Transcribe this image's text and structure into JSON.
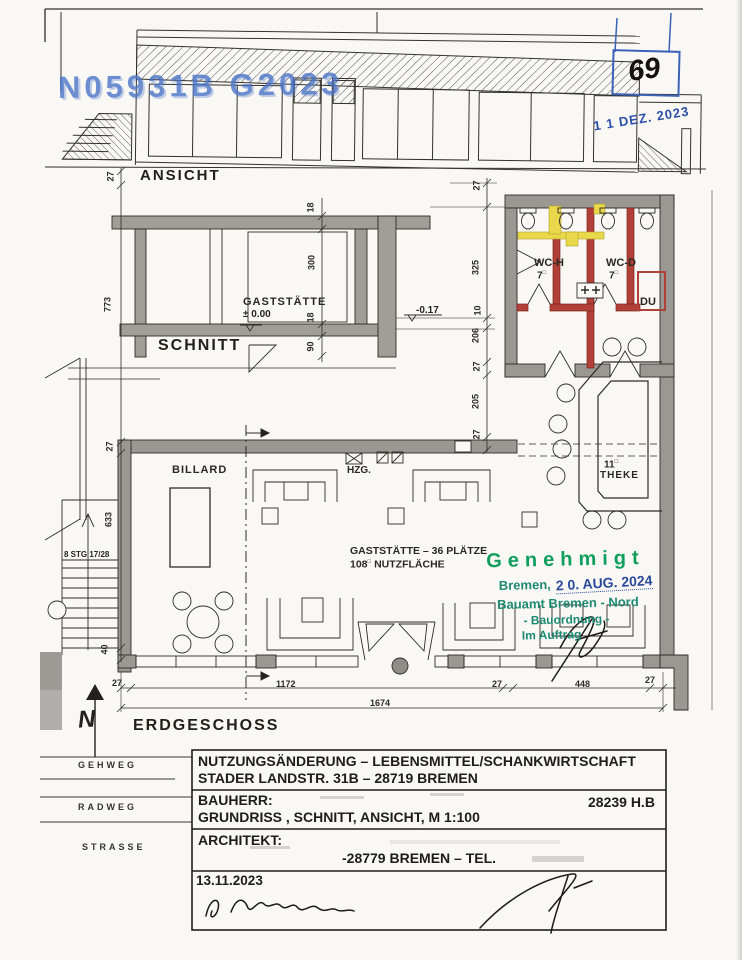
{
  "stamps": {
    "file_number": "N05931B G2023",
    "sheet_number": "69",
    "received_date": "1 1 DEZ. 2023",
    "approval": {
      "title": "Genehmigt",
      "city_prefix": "Bremen,",
      "city_date": "2 0. AUG. 2024",
      "authority": "Bauamt Bremen - Nord",
      "department": "- Bauordnung -",
      "by_order": "Im Auftrag"
    }
  },
  "views": {
    "elevation_label": "ANSICHT",
    "section_label": "SCHNITT",
    "floor_label": "ERDGESCHOSS"
  },
  "rooms": {
    "gaststaette": "GASTSTÄTTE",
    "level_zero": "± 0.00",
    "level_minus": "-0.17",
    "wc_h": {
      "name": "WC-H",
      "area": "7",
      "unit": "□"
    },
    "wc_d": {
      "name": "WC-D",
      "area": "7",
      "unit": "□"
    },
    "du": "DU",
    "theke": {
      "num": "11",
      "unit": "□",
      "name": "THEKE"
    },
    "billard": "BILLARD",
    "hzg": "HZG.",
    "gast": {
      "line1": "GASTSTÄTTE – 36 PLÄTZE",
      "num": "108",
      "unit": "□",
      "line2": "NUTZFLÄCHE"
    },
    "stairs": "8 STG 17/28"
  },
  "dims": {
    "d27": "27",
    "d773": "773",
    "d633": "633",
    "d40": "40",
    "d18": "18",
    "d300": "300",
    "d90": "90",
    "d325": "325",
    "d10": "10",
    "d206": "206",
    "d205": "205",
    "d1172": "1172",
    "d448": "448",
    "d1674": "1674"
  },
  "streets": {
    "gehweg": "GEHWEG",
    "radweg": "RADWEG",
    "strasse": "STRASSE"
  },
  "north": {
    "label": "N"
  },
  "titleblock": {
    "line1": "NUTZUNGSÄNDERUNG – LEBENSMITTEL/SCHANKWIRTSCHAFT",
    "line2": "STADER LANDSTR. 31B – 28719 BREMEN",
    "bauherr_label": "BAUHERR:",
    "file_ref": "28239 H.B",
    "content_line": "GRUNDRISS , SCHNITT, ANSICHT, M 1:100",
    "architekt_label": "ARCHITEKT:",
    "address_line": "-28779 BREMEN – TEL.",
    "date": "13.11.2023"
  }
}
